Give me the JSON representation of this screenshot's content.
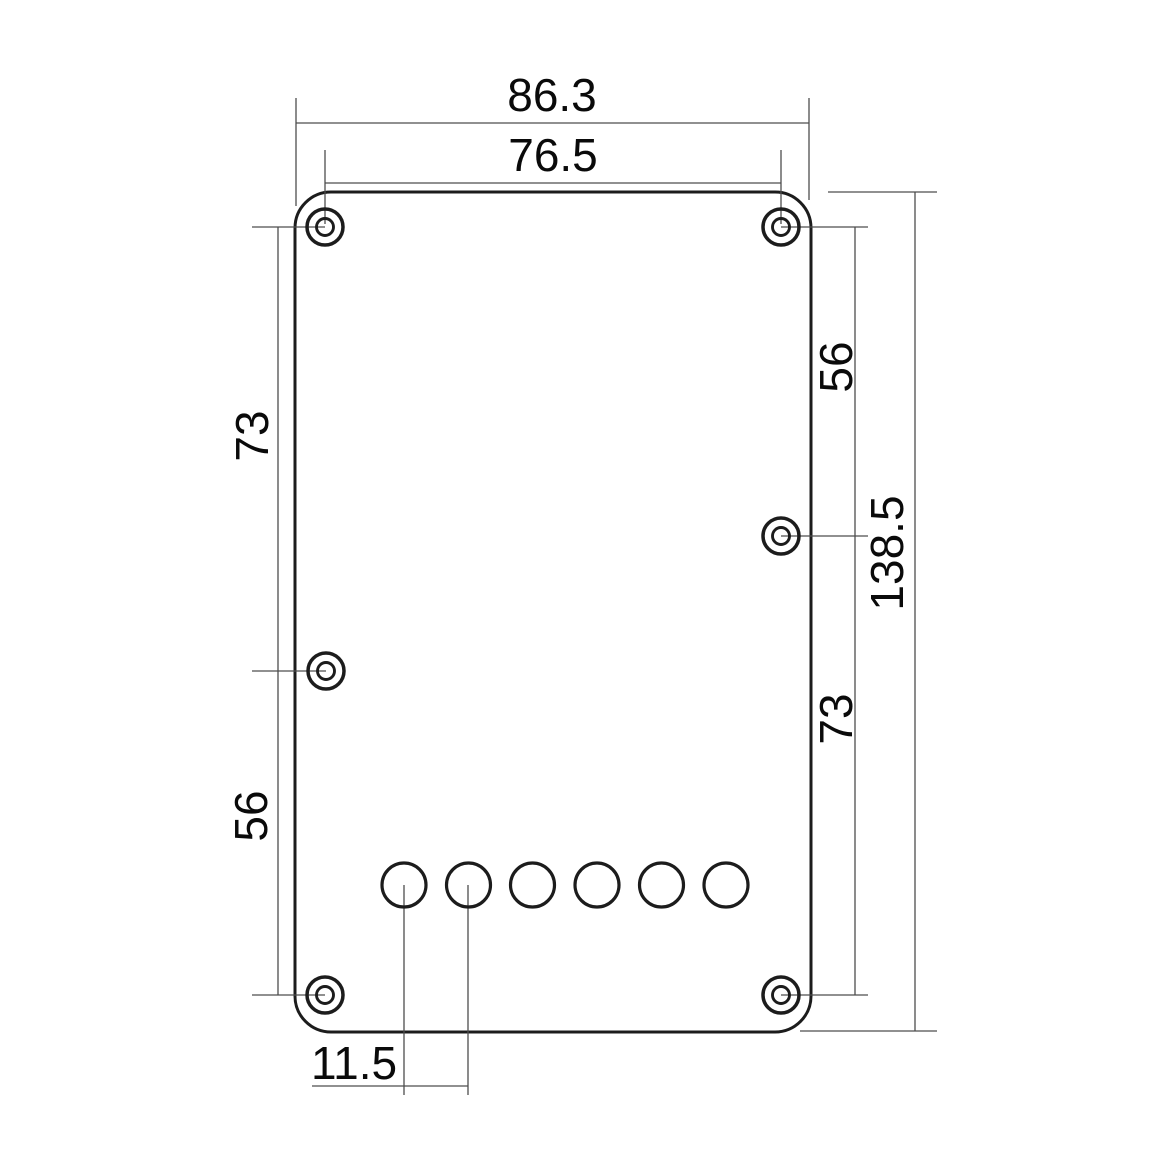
{
  "drawing": {
    "dim_labels": {
      "overall_width": "86.3",
      "top_hole_span": "76.5",
      "left_upper_span": "73",
      "left_lower_span": "56",
      "right_upper_span": "56",
      "right_lower_span": "73",
      "overall_height": "138.5",
      "string_hole_pitch": "11.5"
    },
    "counts": {
      "screw_holes": 6,
      "string_holes": 6
    },
    "colors": {
      "outline": "#1c1c1c",
      "dimension_line": "#4d4d4d",
      "label_text": "#0a0a0a",
      "background": "#ffffff"
    }
  }
}
